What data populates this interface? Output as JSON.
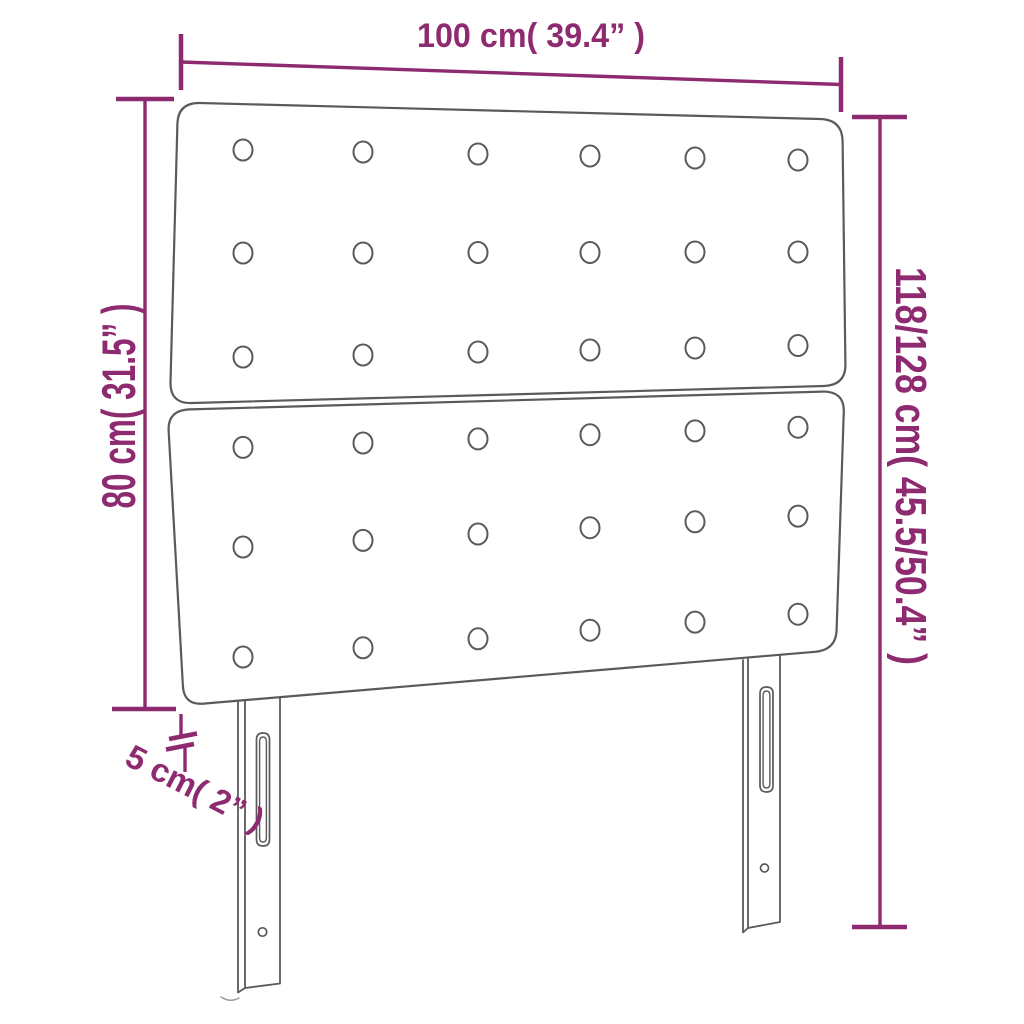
{
  "diagram": {
    "dimensions": {
      "width": {
        "label": "100 cm( 39.4” )"
      },
      "board_height": {
        "label": "80 cm( 31.5” )"
      },
      "total_height": {
        "label": "118/128 cm( 45.5/50.4” )"
      },
      "depth": {
        "label": "5 cm( 2” )"
      }
    },
    "colors": {
      "accent": "#8e2a70",
      "outline": "#5a5a5c",
      "background": "#ffffff"
    }
  }
}
